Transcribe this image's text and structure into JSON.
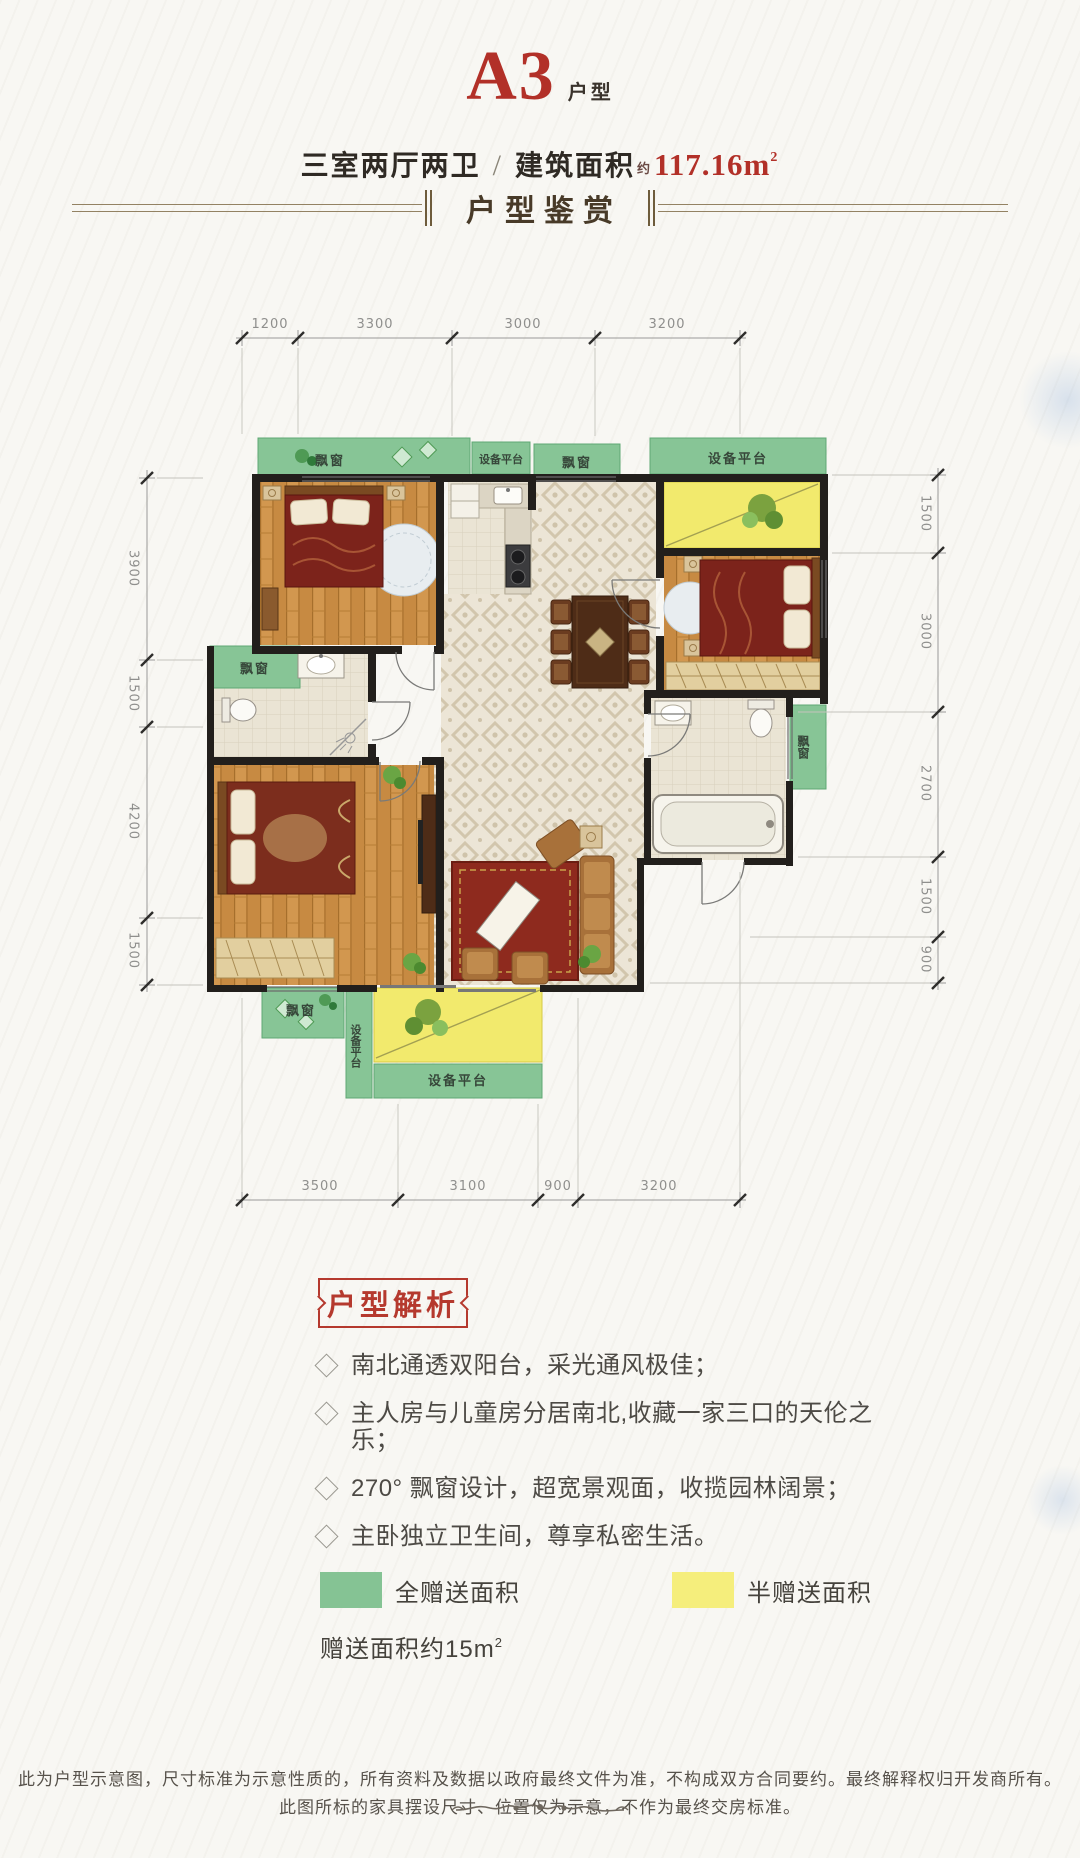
{
  "page": {
    "background": "#f8f7f3"
  },
  "header": {
    "unit": "A3",
    "unit_suffix": "户型",
    "spec": "三室两厅两卫",
    "divider": "/",
    "area_label": "建筑面积",
    "area_approx": "约",
    "area_value": "117.16m",
    "area_sup": "2"
  },
  "appreciation": {
    "title": "户型鉴赏"
  },
  "plan": {
    "dims_top": [
      "1200",
      "3300",
      "3000",
      "3200"
    ],
    "dims_bottom": [
      "3500",
      "3100",
      "900",
      "3200"
    ],
    "dims_left": [
      "3900",
      "1500",
      "4200",
      "1500"
    ],
    "dims_right": [
      "1500",
      "3000",
      "2700",
      "1500",
      "900"
    ],
    "labels": {
      "bay_window": "飘窗",
      "equipment_platform": "设备平台"
    },
    "colors": {
      "full_gift_area": "#85c394",
      "half_gift_area": "#f2ea6d",
      "wall": "#221f1c"
    }
  },
  "analysis": {
    "title": "户型解析",
    "features": [
      "南北通透双阳台，采光通风极佳；",
      "主人房与儿童房分居南北,收藏一家三口的天伦之乐；",
      "270° 飘窗设计，超宽景观面，收揽园林阔景；",
      "主卧独立卫生间，尊享私密生活。"
    ]
  },
  "legend": {
    "full_gift": {
      "label": "全赠送面积",
      "color": "#85c394"
    },
    "half_gift": {
      "label": "半赠送面积",
      "color": "#f5ee7c"
    },
    "note": "赠送面积约15m",
    "note_sup": "2"
  },
  "footer": {
    "line1": "此为户型示意图，尺寸标准为示意性质的，所有资料及数据以政府最终文件为准，不构成双方合同要约。最终解释权归开发商所有。",
    "line2": "此图所标的家具摆设尺寸、位置仅为示意，不作为最终交房标准。"
  }
}
